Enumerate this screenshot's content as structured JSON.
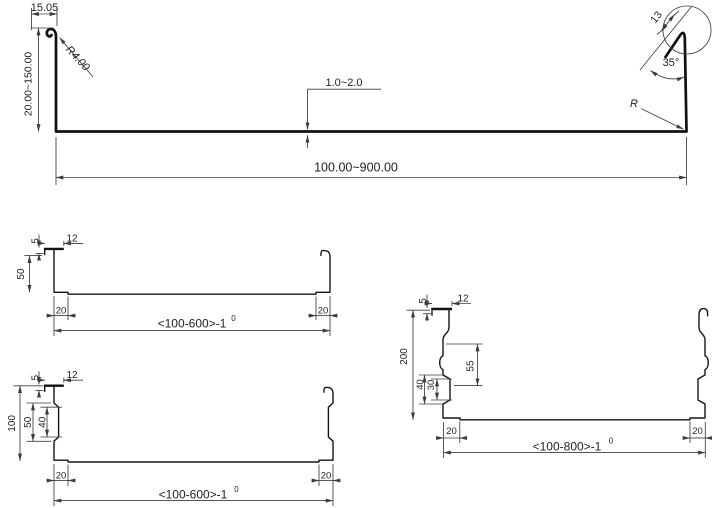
{
  "colors": {
    "background": "#ffffff",
    "profile_line": "#161616",
    "dimension_line": "#3d3d3d",
    "text": "#1f1f1f"
  },
  "main_profile": {
    "hook_width": "15.05",
    "hook_radius": "R4.00",
    "height_range": "20.00~150.00",
    "thickness_range": "1.0~2.0",
    "width_range": "100.00~900.00",
    "lip_length": "13",
    "lip_angle": "35°",
    "corner_radius": "R"
  },
  "channel_a": {
    "lip_return": "5",
    "lip_width": "12",
    "height": "50",
    "foot_left": "20",
    "foot_right": "20",
    "width": "<100-600>-1",
    "width_tolerance_sup": "0"
  },
  "channel_b": {
    "lip_return": "5",
    "lip_width": "12",
    "height": "100",
    "rib_height_outer": "50",
    "rib_height_inner": "40",
    "foot_left": "20",
    "foot_right": "20",
    "width": "<100-600>-1",
    "width_tolerance_sup": "0"
  },
  "channel_c": {
    "lip_return": "5",
    "lip_width": "12",
    "height": "200",
    "rib_spacing": "55",
    "rib_height_outer": "40",
    "rib_height_inner": "30",
    "foot_left": "20",
    "foot_right": "20",
    "width": "<100-800>-1",
    "width_tolerance_sup": "0"
  }
}
